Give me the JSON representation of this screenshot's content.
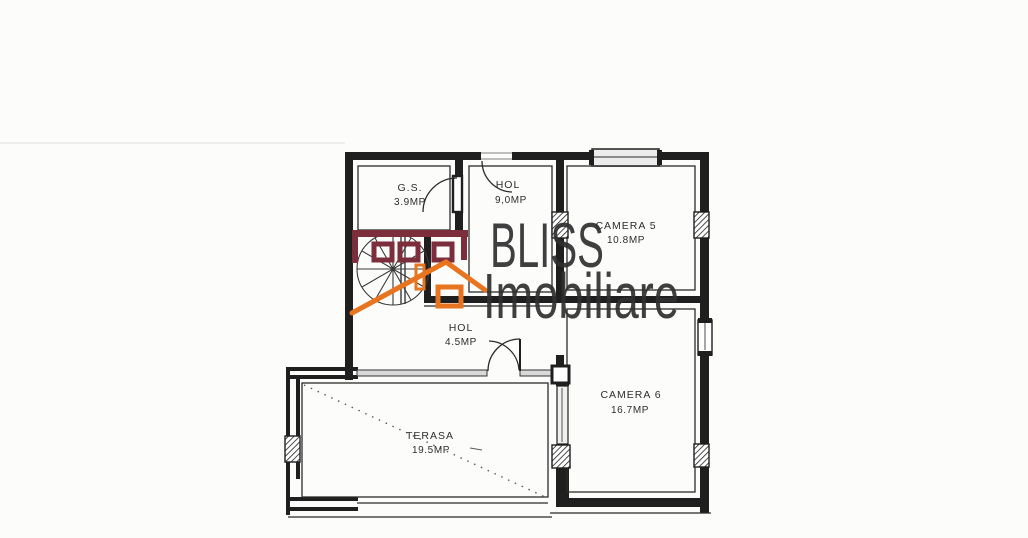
{
  "watermark": {
    "brand": "BLISS",
    "brand_line2": "Imobiliare"
  },
  "rooms": [
    {
      "id": "gs",
      "name": "G.S.",
      "area": "3.9MP"
    },
    {
      "id": "hol-upper",
      "name": "HOL",
      "area": "9,0MP"
    },
    {
      "id": "camera-5",
      "name": "CAMERA 5",
      "area": "10.8MP"
    },
    {
      "id": "hol-lower",
      "name": "HOL",
      "area": "4.5MP"
    },
    {
      "id": "camera-6",
      "name": "CAMERA 6",
      "area": "16.7MP"
    },
    {
      "id": "terasa",
      "name": "TERASA",
      "area": "19.5MP"
    }
  ],
  "colors": {
    "paper": "#fcfcfb",
    "wall": "#1f1f1f",
    "line": "#2a2a2a",
    "glass": "#d9d9d9",
    "logo_orange": "#e8741f",
    "logo_maroon": "#7c2e3d"
  }
}
